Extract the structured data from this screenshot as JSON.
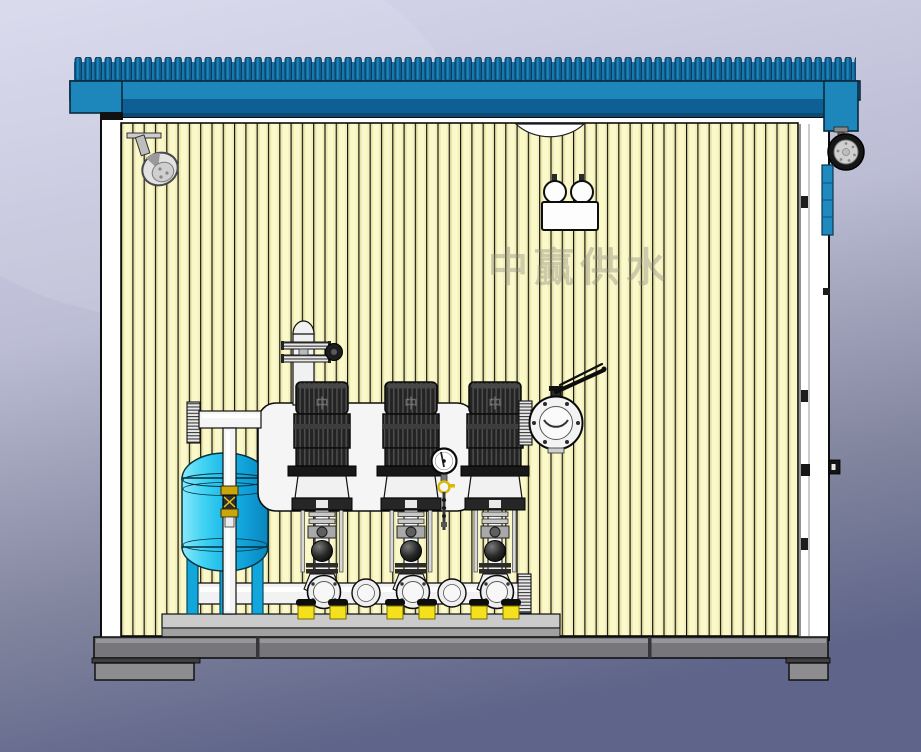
{
  "scene": {
    "watermark_text": "中赢供水",
    "motor_logo_text": "中"
  },
  "palette": {
    "background_top": "#d4d4e9",
    "background_bottom": "#5f658a",
    "roof_blue": "#1d87bc",
    "roof_rib_blue": "#0e6094",
    "roof_shadow_band": "#0e5f93",
    "wall_cream": "#fbf8c9",
    "wall_trim_white": "#ffffff",
    "tank_cyan": "#1ec1ee",
    "pipe_white": "#f2f2f2",
    "motor_dark": "#242424",
    "anchor_yellow": "#f3e11e",
    "brass_yellow": "#caa50c",
    "base_frame_gray": "#77777b",
    "floor_slab_gray": "#cbcbcb"
  },
  "components": {
    "enclosure": "booster-pump-station-cabinet",
    "roof": "corrugated-blue-roof",
    "wall": "cream-corrugated-wall-panels",
    "ceiling_spotlight": "ceiling-spotlight",
    "ceiling_vent": "ceiling-dome-vent",
    "emergency_light": "twin-lamp-emergency-light",
    "exterior_lamp": "exterior-wall-lamp",
    "side_louver": "blue-side-louver-panel",
    "door": "right-side-access-door",
    "pressure_tank": "blue-diaphragm-pressure-tank",
    "pumps": "vertical-multistage-pumps-x3",
    "discharge_header": "discharge-header-vessel",
    "discharge_pipe": "discharge-manifold-pipe",
    "suction_manifold": "suction-manifold-pipe",
    "butterfly_valve": "lever-butterfly-valve",
    "air_valve": "air-release-valve-riser",
    "pressure_gauge": "pressure-gauge",
    "tank_riser": "tank-riser-pipe-with-brass-valve",
    "base": "base-frame-and-feet",
    "skid": "equipment-skid-base"
  }
}
